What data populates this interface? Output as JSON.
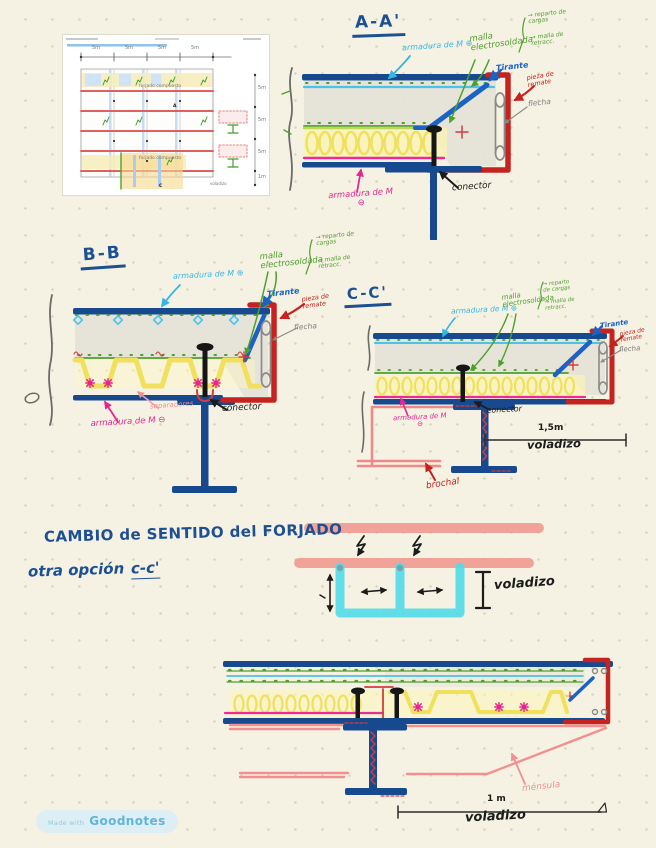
{
  "app": {
    "made_with": "Made with",
    "app_name": "Goodnotes"
  },
  "notes": {
    "heading": "CAMBIO de SENTIDO del FORJADO",
    "option_prefix": "otra opción",
    "option_ref": "c-c'"
  },
  "sections": {
    "aa": {
      "title": "A-A'"
    },
    "bb": {
      "title": "B-B"
    },
    "cc": {
      "title": "C-C'"
    }
  },
  "labels": {
    "armadura_pos": "armadura de M ⊕",
    "malla": "malla electrosoldada",
    "reparto": "→ reparto de cargas",
    "retraccion": "→ malla de retracc.",
    "tirante": "Tirante",
    "remate": "pieza de remate",
    "flecha": "flecha",
    "armadura_neg": "armadura de M ⊖",
    "conector": "conector",
    "separadores": "separadores",
    "brochal": "brochal",
    "mensula": "ménsula",
    "voladizo": "voladizo"
  },
  "dims": {
    "cc_length": "1,5m",
    "bottom_length": "1 m"
  },
  "plan_inset": {
    "top_dims": [
      "5m",
      "5m",
      "5m",
      "5m"
    ],
    "right_dims": [
      "5m",
      "5m",
      "5m",
      "1m"
    ],
    "area_label_1": "forjado compuesto",
    "area_label_2": "forjado compuesto",
    "mark_a": "A",
    "mark_c": "C",
    "bottom_label": "voladizo"
  },
  "colors": {
    "ink_blue": "#1d4f93",
    "structure_blue": "#17498f",
    "cyan": "#35b6e4",
    "green": "#4ea02c",
    "yellow": "#f0e05e",
    "magenta": "#e8258f",
    "red": "#c4231f",
    "salmon": "#f0958c",
    "light_pink": "#f5a0a8",
    "gray": "#8a8a88",
    "paper": "#f5f2e3"
  }
}
